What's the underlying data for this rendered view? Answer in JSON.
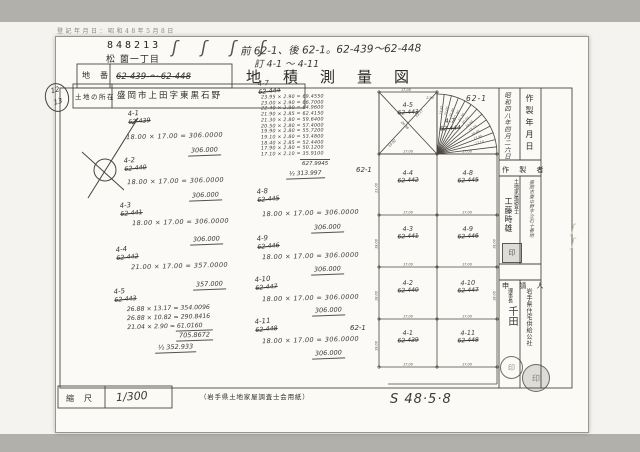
{
  "header": {
    "reg_note": "登記年月日：昭和48年5月8日",
    "doc_number": "848213",
    "town": "松 薗一丁目",
    "squiggles": "ʃ ʃ ʃ ʃ",
    "annot1": "前 62-1、後 62-1。62-439〜62-448",
    "annot2": "訂 4-1 〜 4-11",
    "title": "地積測量図",
    "lot_label": "地番",
    "lot_value": "62-439-〜-62-448",
    "loc_label": "土地の所在",
    "loc_value": "盛岡市上田字東黒石野",
    "page_top": "12",
    "page_bottom": "13"
  },
  "calc": {
    "left": [
      {
        "nw": "4-1",
        "od": "62-439",
        "line": "18.00 × 17.00 = 306.0000",
        "result": "306.000"
      },
      {
        "nw": "4-2",
        "od": "62-440",
        "line": "18.00 × 17.00 = 306.0000",
        "result": "306.000"
      },
      {
        "nw": "4-3",
        "od": "62-441",
        "line": "18.00 × 17.00 = 306.0000",
        "result": "306.000"
      },
      {
        "nw": "4-4",
        "od": "62-442",
        "line": "21.00 × 17.00 = 357.0000",
        "result": "357.000"
      },
      {
        "nw": "4-5",
        "od": "62-443",
        "lines": [
          "26.88 × 13.17 = 354.0096",
          "26.88 × 10.82 = 290.8416",
          "21.04 ×  2.90 =  61.0160"
        ],
        "total": "705.8672",
        "half": "½  352.933"
      }
    ],
    "fan": {
      "nw": "4-7",
      "od": "62-444",
      "lines": [
        "23.95 × 2.90 = 69.4550",
        "23.00 × 2.90 = 66.7000",
        "22.40 × 2.90 = 64.9600",
        "21.90 × 2.85 = 62.4150",
        "21.30 × 2.80 = 59.6400",
        "20.50 × 2.80 = 57.4000",
        "19.90 × 2.80 = 55.7200",
        "19.10 × 2.80 = 53.4800",
        "18.40 × 2.85 = 52.4400",
        "17.90 × 2.80 = 50.1200",
        "17.10 × 2.10 = 35.9100"
      ],
      "total": "627.9945",
      "half": "½  313.997"
    },
    "right": [
      {
        "nw": "4-8",
        "od": "62-445",
        "line": "18.00 × 17.00 = 306.0000",
        "result": "306.000"
      },
      {
        "nw": "4-9",
        "od": "62-446",
        "line": "18.00 × 17.00 = 306.0000",
        "result": "306.000"
      },
      {
        "nw": "4-10",
        "od": "62-447",
        "line": "18.00 × 17.00 = 306.0000",
        "result": "306.000"
      },
      {
        "nw": "4-11",
        "od": "62-448",
        "line": "18.00 × 17.00 = 306.0000",
        "result": "306.000"
      }
    ]
  },
  "map": {
    "parcels": [
      {
        "nw": "4-5",
        "od": "62-443"
      },
      {
        "nw": "4-7",
        "od": "62-444"
      },
      {
        "nw": "4-4",
        "od": "62-442"
      },
      {
        "nw": "4-8",
        "od": "62-445"
      },
      {
        "nw": "4-3",
        "od": "62-441"
      },
      {
        "nw": "4-9",
        "od": "62-446"
      },
      {
        "nw": "4-2",
        "od": "62-440"
      },
      {
        "nw": "4-10",
        "od": "62-447"
      },
      {
        "nw": "4-1",
        "od": "62-439"
      },
      {
        "nw": "4-11",
        "od": "62-448"
      }
    ],
    "neighbor": "62-1",
    "w17": "17.00",
    "d18": "18.00",
    "d21": "21.00",
    "rays": [
      "23.95",
      "23.00",
      "22.40",
      "21.90",
      "21.30",
      "20.50",
      "19.90",
      "19.10",
      "18.40",
      "17.90",
      "17.10"
    ],
    "diag": [
      "26.88",
      "13.17",
      "10.82",
      "2.90"
    ]
  },
  "sidebar": {
    "date_label": "作製年月日",
    "date_value": "昭和四八年四月二六日",
    "maker_label": "作 製 者",
    "maker_addr": "盛岡市東中野字立石十番地",
    "maker_title": "土地家屋調査士",
    "maker_name": "工藤時雄",
    "maker_stamp": "印",
    "applicant_label": "申 請 人",
    "applicant_org": "岩手県住宅供給公社",
    "applicant_title": "理事長",
    "applicant_name": "千田",
    "applicant_stamp": "印"
  },
  "footer": {
    "scale_label": "縮尺",
    "scale_value": "1/300",
    "paper_note": "（岩手県土地家屋調査士会用紙）",
    "date_written": "S 48·5·8"
  },
  "misc": {
    "scribble": "ʃʃ"
  }
}
